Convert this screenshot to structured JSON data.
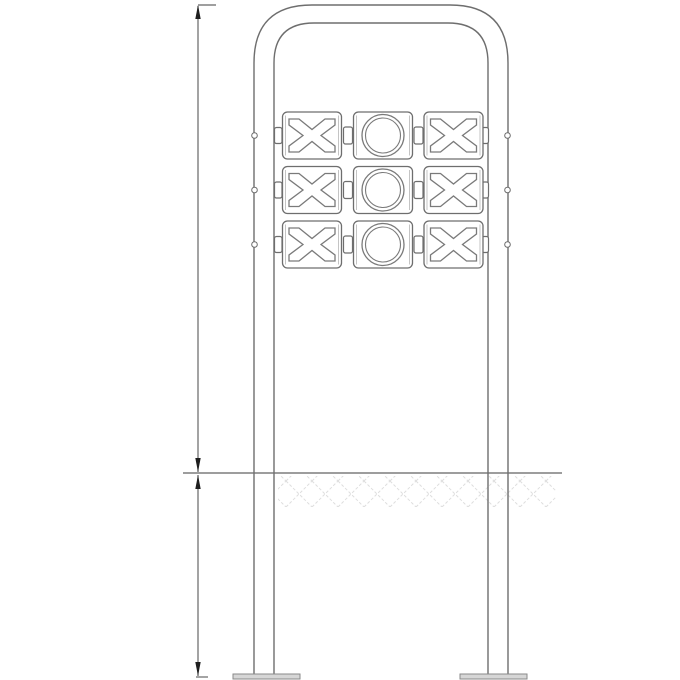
{
  "drawing": {
    "kind": "technical-elevation",
    "description": "Front elevation line drawing of a tic-tac-toe spinner play panel mounted in an inverted-U tube frame with two posts, ground line with hatch, buried post section and base plates",
    "grid": {
      "rows": 3,
      "cols": 3,
      "symbols": [
        [
          "X",
          "O",
          "X"
        ],
        [
          "X",
          "O",
          "X"
        ],
        [
          "X",
          "O",
          "X"
        ]
      ]
    },
    "annotations": {
      "upper_dimension_label": "",
      "lower_dimension_label": ""
    },
    "colors": {
      "background": "#ffffff",
      "outline": "#6e6e6e",
      "outline_light": "#b5b5b5",
      "symbol": "#7a7a7a",
      "dimension_line": "#666666",
      "arrowhead": "#1e1e1e",
      "ground_line": "#7d7d7d",
      "hatch": "#dedede",
      "base_fill": "#d6d6d6",
      "base_stroke": "#8a8a8a"
    }
  }
}
